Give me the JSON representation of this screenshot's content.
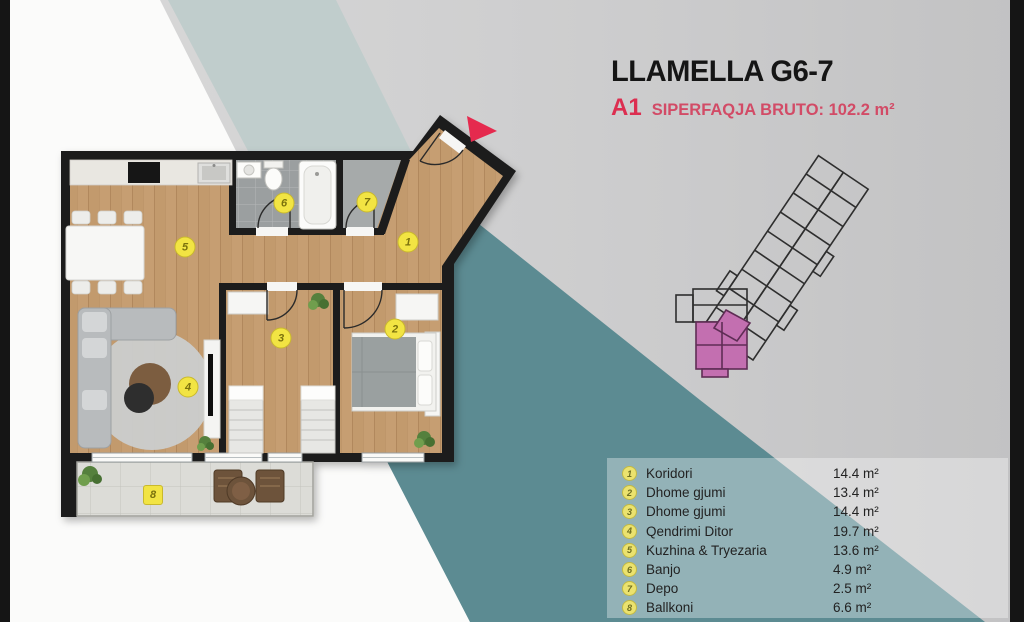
{
  "colors": {
    "accent_red": "#dc2e50",
    "teal_band": "#5c8b92",
    "pale_teal_band": "#c0cdcc",
    "marker_yellow": "#f2e443",
    "keyplan_pink": "#c36fb0",
    "wall_black": "#1b1b1b",
    "wood_floor": "#c69e72"
  },
  "header": {
    "title": "LLAMELLA G6-7",
    "unit": "A1",
    "area_label": "SIPERFAQJA BRUTO: 102.2 m²"
  },
  "legend": {
    "rows": [
      {
        "num": "1",
        "label": "Koridori",
        "area": "14.4 m²"
      },
      {
        "num": "2",
        "label": "Dhome gjumi",
        "area": "13.4 m²"
      },
      {
        "num": "3",
        "label": "Dhome gjumi",
        "area": "14.4 m²"
      },
      {
        "num": "4",
        "label": "Qendrimi Ditor",
        "area": "19.7 m²"
      },
      {
        "num": "5",
        "label": "Kuzhina & Tryezaria",
        "area": "13.6 m²"
      },
      {
        "num": "6",
        "label": "Banjo",
        "area": "4.9 m²"
      },
      {
        "num": "7",
        "label": "Depo",
        "area": "2.5 m²"
      },
      {
        "num": "8",
        "label": "Ballkoni",
        "area": "6.6 m²"
      }
    ]
  },
  "plan": {
    "markers": [
      {
        "n": "1"
      },
      {
        "n": "2"
      },
      {
        "n": "3"
      },
      {
        "n": "4"
      },
      {
        "n": "5"
      },
      {
        "n": "6"
      },
      {
        "n": "7"
      },
      {
        "n": "8"
      }
    ]
  }
}
